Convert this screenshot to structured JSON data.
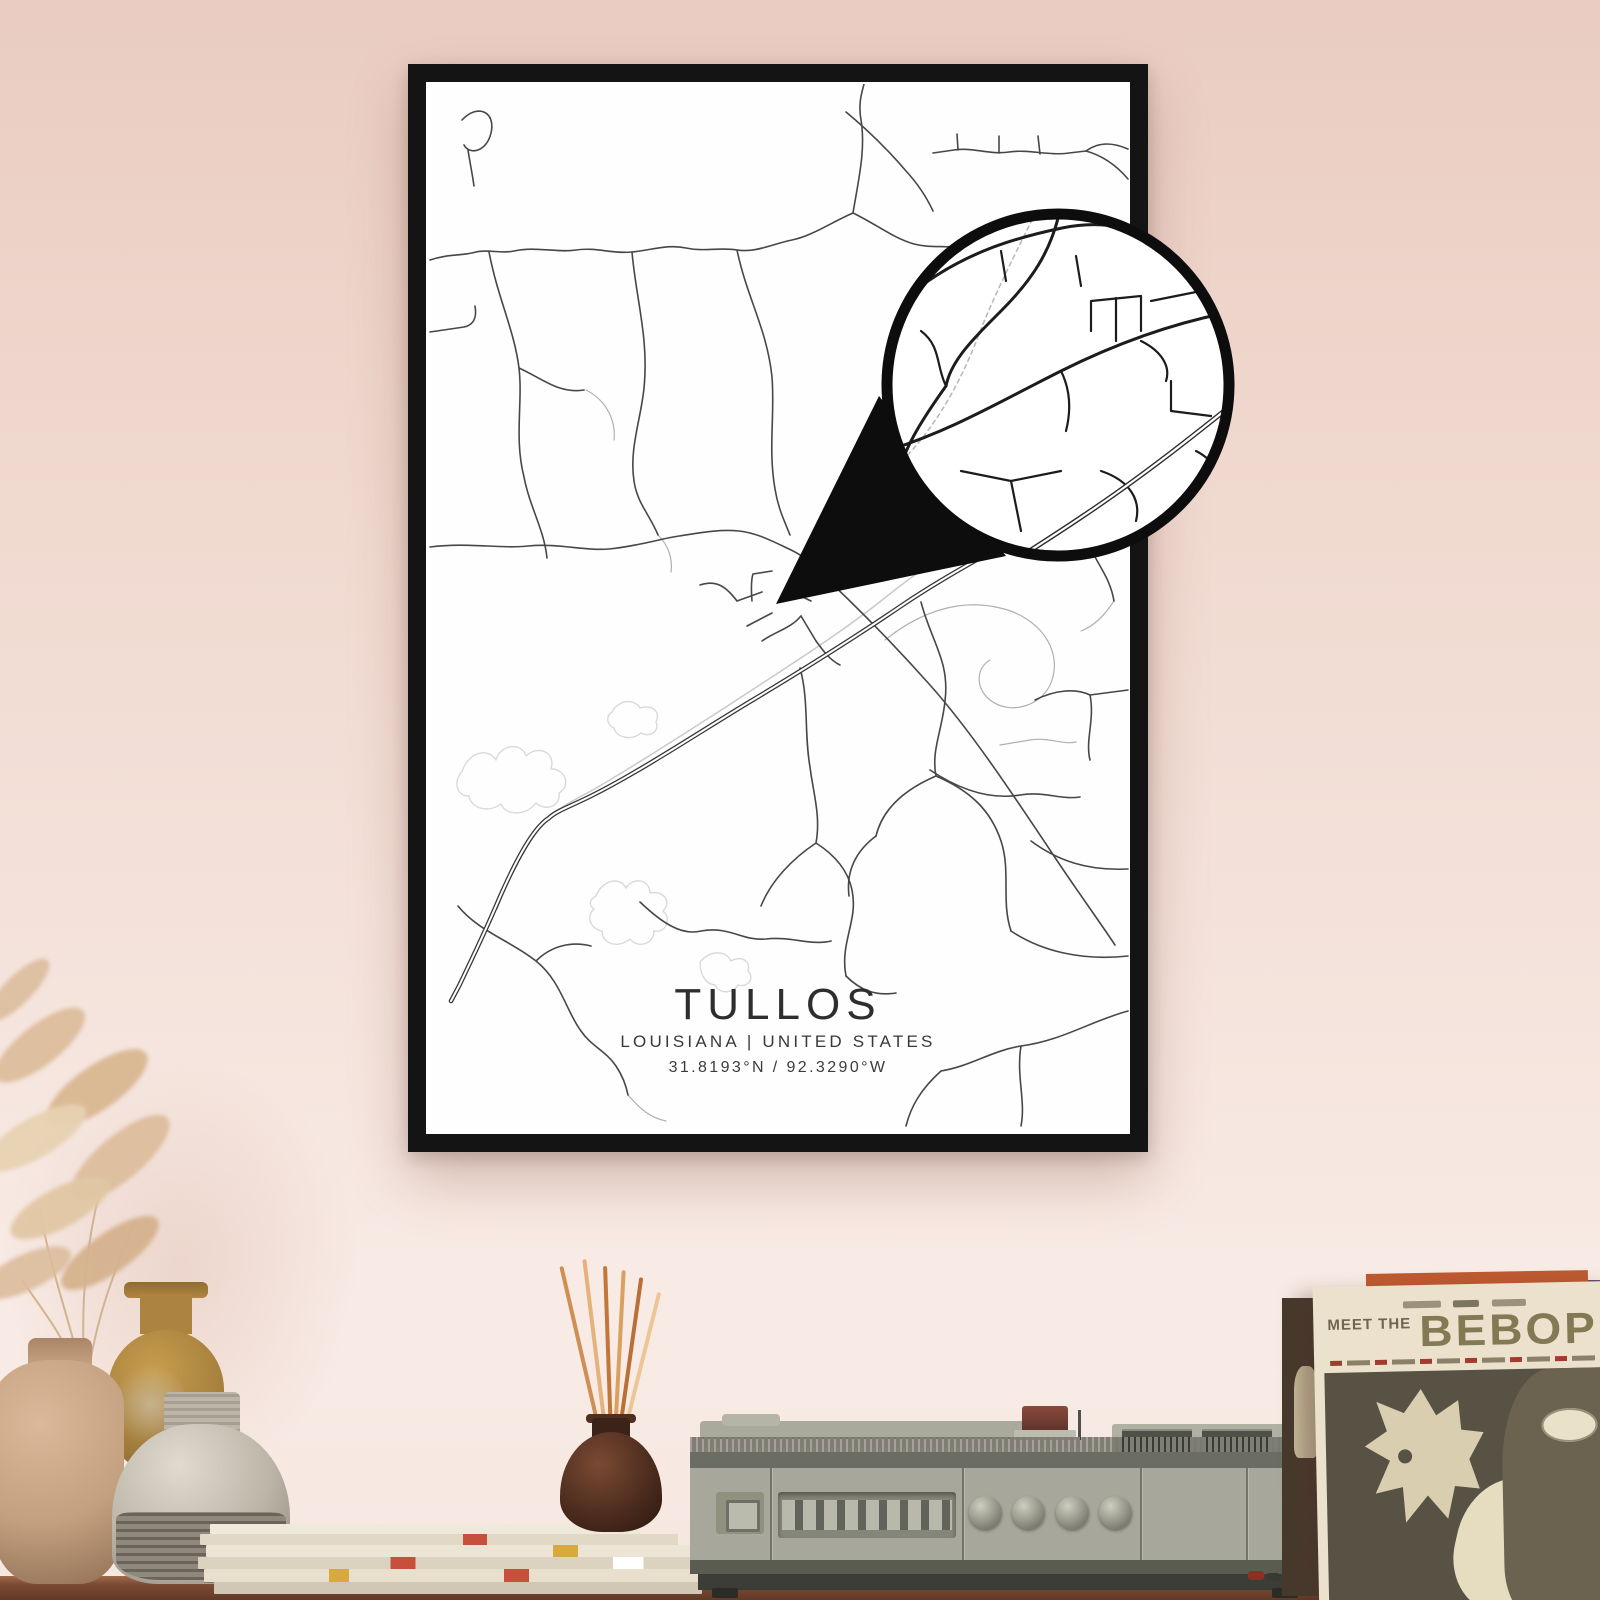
{
  "poster": {
    "title": "TULLOS",
    "subtitle": "LOUISIANA | UNITED STATES",
    "coordinates": "31.8193°N / 92.3290°W"
  },
  "record_sleeve": {
    "meet_the": "MEET THE",
    "album_title": "BEBOP"
  },
  "colors": {
    "wall_top": "#eaccc1",
    "wall_bottom": "#f6e7e0",
    "frame": "#141414",
    "poster_paper": "#fefefe",
    "map_road_dark": "#474747",
    "map_road_light": "#b5b5b5",
    "map_water_outline": "#d9d9d9",
    "magnifier_ring": "#0d0d0d",
    "table_wood": "#7c4b34",
    "player_body": "#a7a89b",
    "sleeve_cream": "#ebe1cc",
    "sleeve_text": "#847955",
    "sleeve_artwork_bg": "#575243",
    "incense_stick": "#cd8a4d",
    "vase_tan": "#c3a07f",
    "vase_mustard": "#a57f3c",
    "vase_gray": "#bcb5a8",
    "pampas_grass": "#dcbd9c"
  }
}
